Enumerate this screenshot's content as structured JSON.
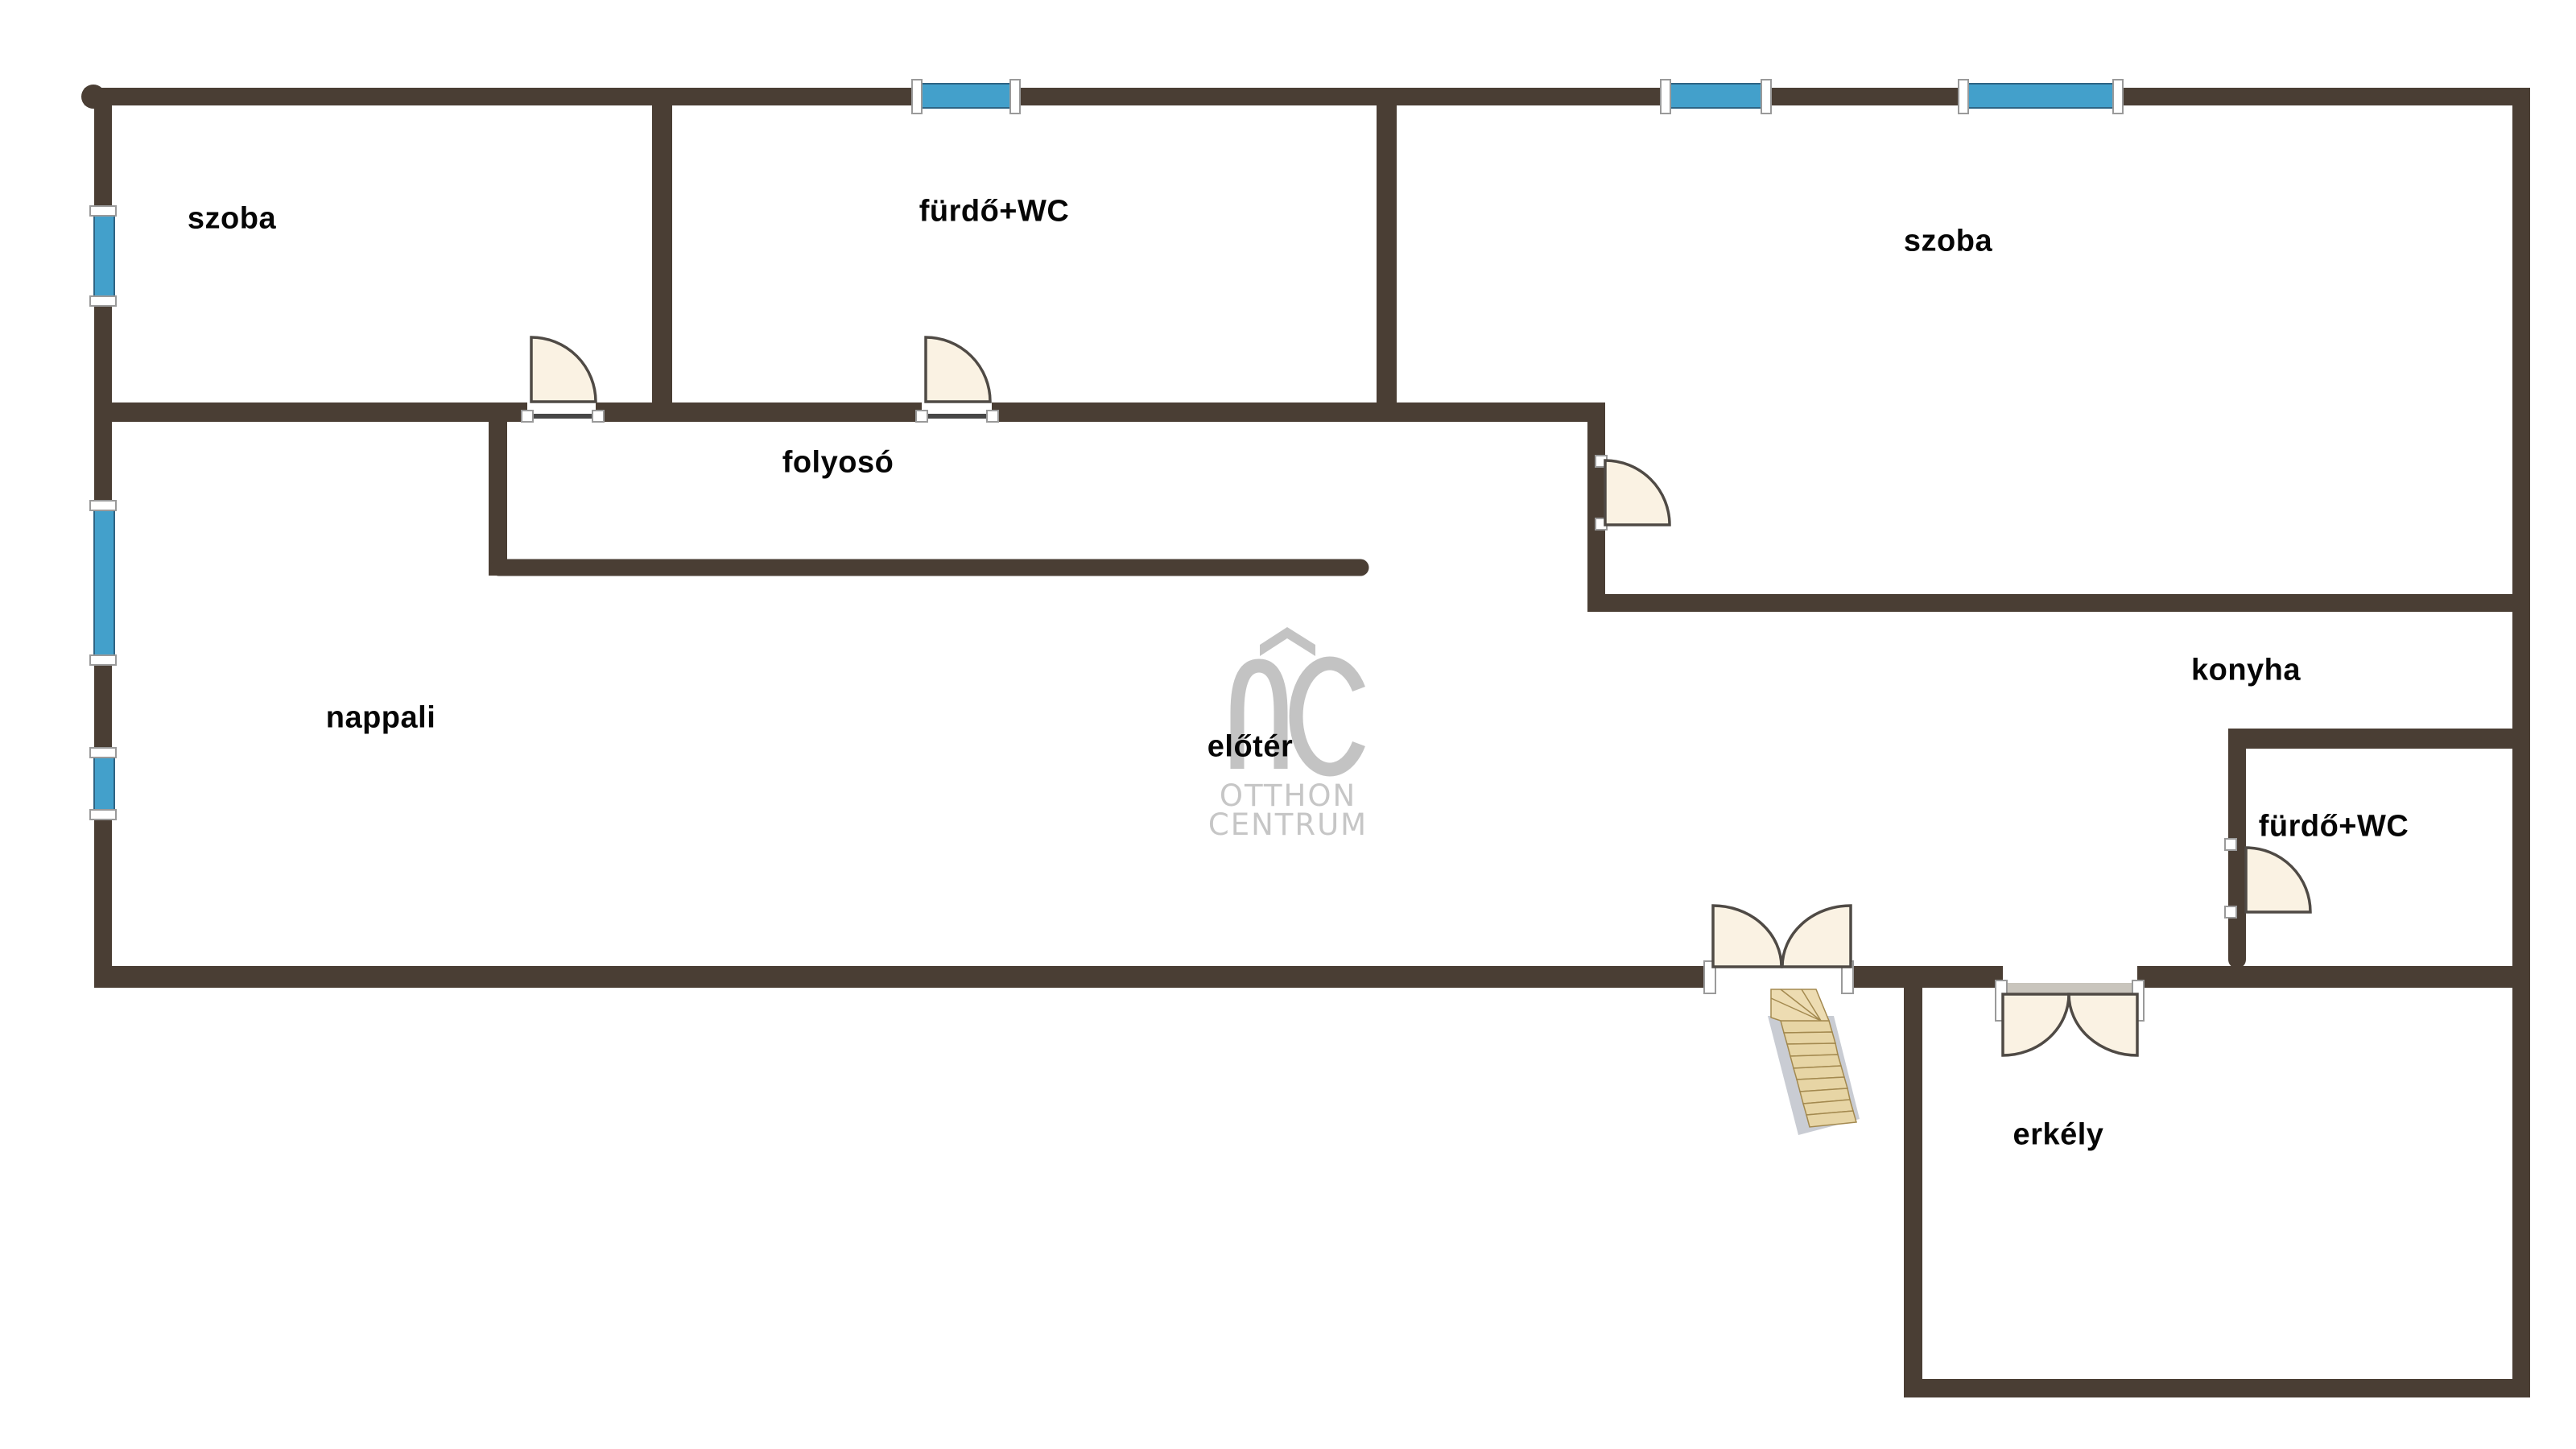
{
  "floor_plan": {
    "rooms": [
      {
        "id": "szoba-left",
        "label": "szoba"
      },
      {
        "id": "furdo-wc-top",
        "label": "fürdő+WC"
      },
      {
        "id": "szoba-right",
        "label": "szoba"
      },
      {
        "id": "folyoso",
        "label": "folyosó"
      },
      {
        "id": "nappali",
        "label": "nappali"
      },
      {
        "id": "eloter",
        "label": "előtér"
      },
      {
        "id": "konyha",
        "label": "konyha"
      },
      {
        "id": "furdo-wc-bottom",
        "label": "fürdő+WC"
      },
      {
        "id": "erkely",
        "label": "erkély"
      }
    ],
    "watermark": {
      "symbol_letter": "C",
      "line1": "OTTHON",
      "line2": "CENTRUM"
    },
    "colors": {
      "wall": "#4a3e34",
      "window": "#43a0cb",
      "window_stroke": "#2e6484",
      "bracket": "#ffffff",
      "door_fill": "#faf2e3",
      "door_stroke": "#4f4a45",
      "threshold_dark": "#474747",
      "threshold_gray": "#c9c5bd",
      "stair_wood": "#e7d5a5",
      "stair_platform": "#eddcb2",
      "stair_stringer": "#c9ccd3",
      "logo_gray": "#c3c3c3",
      "logo_text_gray": "#c6c6c6"
    }
  }
}
